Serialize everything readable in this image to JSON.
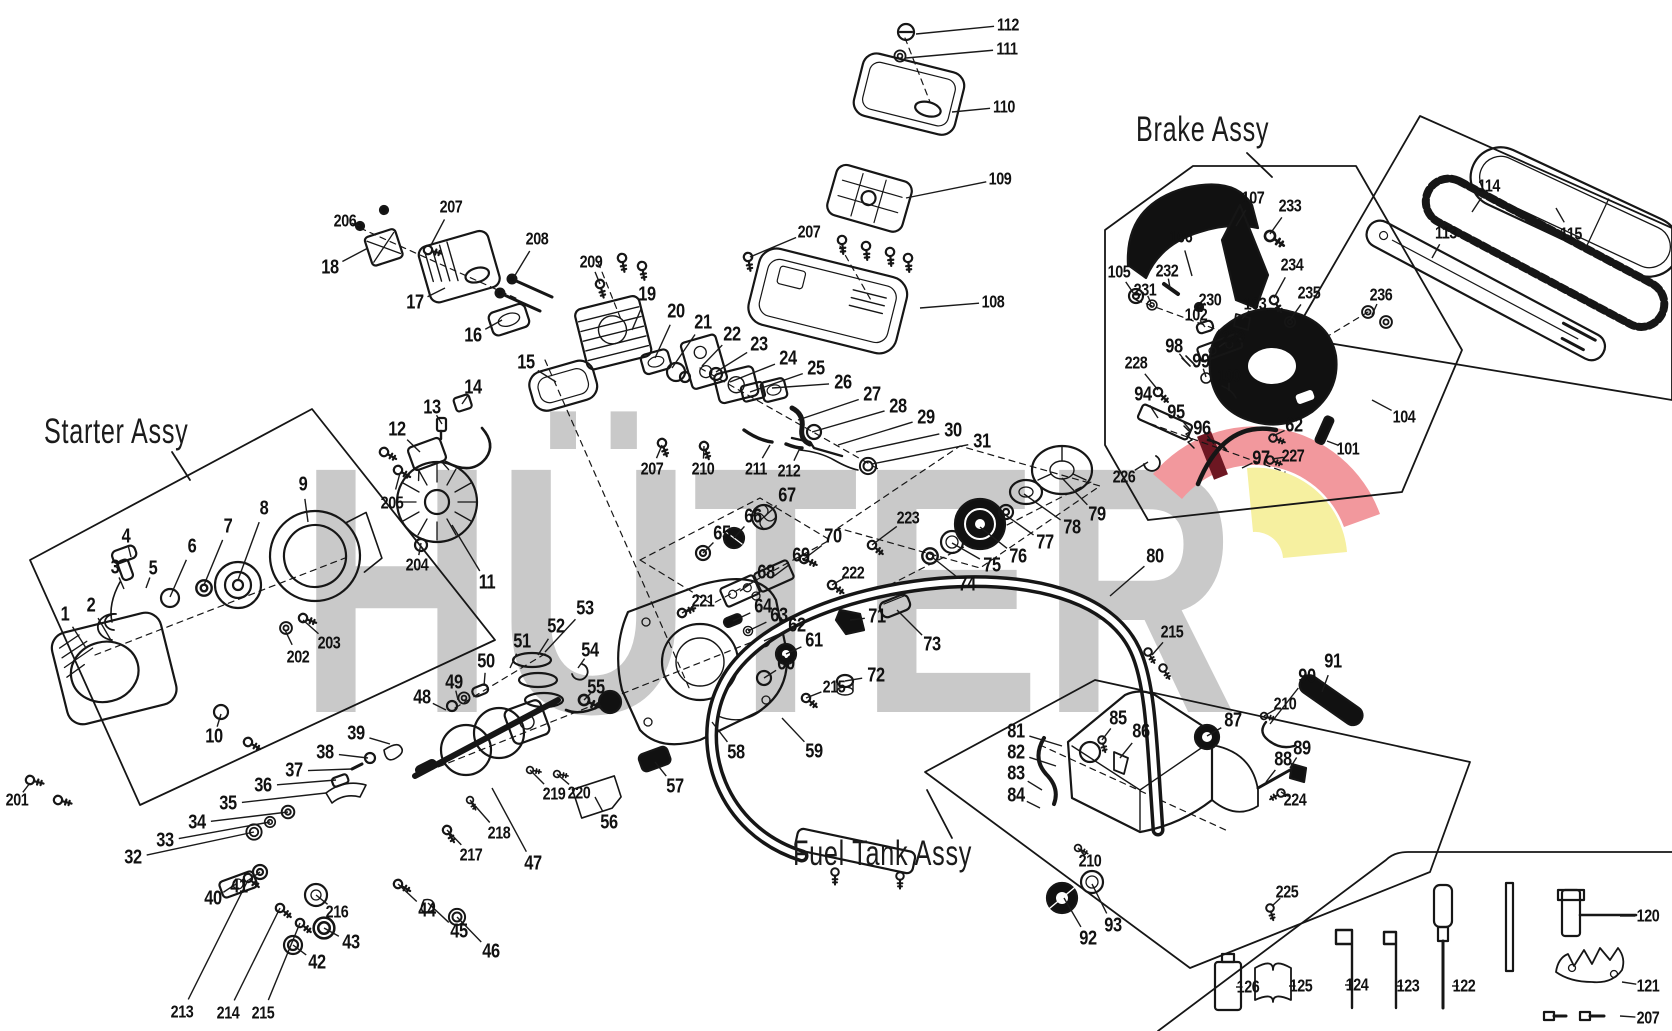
{
  "diagram": {
    "brand_watermark": "HÜTER",
    "watermark_color": "#c9c9c9",
    "line_color": "#1a1a1a",
    "background": "#ffffff",
    "emblem": {
      "band": "#f2989d",
      "stripe": "#6d1722",
      "wedge": "#f6f0a0"
    }
  },
  "groups": [
    {
      "id": "starter",
      "label": "Starter Assy"
    },
    {
      "id": "brake",
      "label": "Brake Assy"
    },
    {
      "id": "fuel",
      "label": "Fuel Tank Assy"
    }
  ],
  "callouts": [
    {
      "id": "112",
      "x": 1008,
      "y": 25,
      "tx": 916,
      "ty": 34
    },
    {
      "id": "111",
      "x": 1007,
      "y": 49,
      "tx": 906,
      "ty": 58
    },
    {
      "id": "110",
      "x": 1004,
      "y": 107,
      "tx": 952,
      "ty": 112
    },
    {
      "id": "109",
      "x": 1000,
      "y": 179,
      "tx": 906,
      "ty": 198
    },
    {
      "id": "108",
      "x": 993,
      "y": 302,
      "tx": 920,
      "ty": 308
    },
    {
      "id": "207",
      "x": 809,
      "y": 232,
      "tx": 750,
      "ty": 257
    },
    {
      "id": "209",
      "x": 591,
      "y": 262,
      "tx": 600,
      "ty": 284
    },
    {
      "id": "206",
      "x": 345,
      "y": 221,
      "tx": 360,
      "ty": 226
    },
    {
      "id": "207",
      "x": 451,
      "y": 207,
      "tx": 430,
      "ty": 247
    },
    {
      "id": "18",
      "x": 330,
      "y": 268,
      "tx": 368,
      "ty": 248
    },
    {
      "id": "17",
      "x": 415,
      "y": 303,
      "tx": 445,
      "ty": 288
    },
    {
      "id": "208",
      "x": 537,
      "y": 239,
      "tx": 514,
      "ty": 277
    },
    {
      "id": "16",
      "x": 473,
      "y": 336,
      "tx": 502,
      "ty": 320
    },
    {
      "id": "15",
      "x": 526,
      "y": 363,
      "tx": 556,
      "ty": 382
    },
    {
      "id": "19",
      "x": 647,
      "y": 295,
      "tx": 632,
      "ty": 330
    },
    {
      "id": "20",
      "x": 676,
      "y": 312,
      "tx": 655,
      "ty": 358
    },
    {
      "id": "21",
      "x": 703,
      "y": 323,
      "tx": 672,
      "ty": 368
    },
    {
      "id": "22",
      "x": 732,
      "y": 335,
      "tx": 702,
      "ty": 366
    },
    {
      "id": "23",
      "x": 759,
      "y": 345,
      "tx": 716,
      "ty": 372
    },
    {
      "id": "24",
      "x": 788,
      "y": 359,
      "tx": 730,
      "ty": 382
    },
    {
      "id": "25",
      "x": 816,
      "y": 369,
      "tx": 750,
      "ty": 392
    },
    {
      "id": "26",
      "x": 843,
      "y": 383,
      "tx": 772,
      "ty": 388
    },
    {
      "id": "27",
      "x": 872,
      "y": 395,
      "tx": 798,
      "ty": 420
    },
    {
      "id": "28",
      "x": 898,
      "y": 407,
      "tx": 812,
      "ty": 432
    },
    {
      "id": "29",
      "x": 926,
      "y": 418,
      "tx": 838,
      "ty": 445
    },
    {
      "id": "30",
      "x": 953,
      "y": 431,
      "tx": 856,
      "ty": 452
    },
    {
      "id": "31",
      "x": 982,
      "y": 442,
      "tx": 872,
      "ty": 464
    },
    {
      "id": "211",
      "x": 756,
      "y": 469,
      "tx": 770,
      "ty": 445
    },
    {
      "id": "212",
      "x": 789,
      "y": 471,
      "tx": 800,
      "ty": 448
    },
    {
      "id": "207",
      "x": 652,
      "y": 469,
      "tx": 662,
      "ty": 445
    },
    {
      "id": "210",
      "x": 703,
      "y": 469,
      "tx": 704,
      "ty": 446
    },
    {
      "id": "12",
      "x": 397,
      "y": 430,
      "tx": 420,
      "ty": 452
    },
    {
      "id": "13",
      "x": 432,
      "y": 408,
      "tx": 442,
      "ty": 424
    },
    {
      "id": "14",
      "x": 473,
      "y": 388,
      "tx": 462,
      "ty": 404
    },
    {
      "id": "205",
      "x": 392,
      "y": 503,
      "tx": 400,
      "ty": 473
    },
    {
      "id": "204",
      "x": 417,
      "y": 565,
      "tx": 421,
      "ty": 543
    },
    {
      "id": "11",
      "x": 487,
      "y": 583,
      "tx": 452,
      "ty": 525
    },
    {
      "id": "1",
      "x": 65,
      "y": 615,
      "tx": 86,
      "ty": 648
    },
    {
      "id": "2",
      "x": 91,
      "y": 606,
      "tx": 112,
      "ty": 642
    },
    {
      "id": "3",
      "x": 115,
      "y": 568,
      "tx": 124,
      "ty": 589
    },
    {
      "id": "4",
      "x": 126,
      "y": 537,
      "tx": 131,
      "ty": 557
    },
    {
      "id": "5",
      "x": 153,
      "y": 569,
      "tx": 146,
      "ty": 588
    },
    {
      "id": "6",
      "x": 192,
      "y": 547,
      "tx": 170,
      "ty": 597
    },
    {
      "id": "7",
      "x": 228,
      "y": 527,
      "tx": 204,
      "ty": 585
    },
    {
      "id": "8",
      "x": 264,
      "y": 509,
      "tx": 238,
      "ty": 580
    },
    {
      "id": "9",
      "x": 303,
      "y": 485,
      "tx": 308,
      "ty": 522
    },
    {
      "id": "10",
      "x": 214,
      "y": 737,
      "tx": 221,
      "ty": 714
    },
    {
      "id": "201",
      "x": 17,
      "y": 800,
      "tx": 30,
      "ty": 783
    },
    {
      "id": "202",
      "x": 298,
      "y": 657,
      "tx": 285,
      "ty": 630
    },
    {
      "id": "203",
      "x": 329,
      "y": 643,
      "tx": 303,
      "ty": 620
    },
    {
      "id": "52",
      "x": 556,
      "y": 627,
      "tx": 538,
      "ty": 655
    },
    {
      "id": "53",
      "x": 585,
      "y": 609,
      "tx": 545,
      "ty": 652
    },
    {
      "id": "51",
      "x": 522,
      "y": 642,
      "tx": 510,
      "ty": 668
    },
    {
      "id": "50",
      "x": 486,
      "y": 662,
      "tx": 484,
      "ty": 686
    },
    {
      "id": "49",
      "x": 454,
      "y": 683,
      "tx": 458,
      "ty": 700
    },
    {
      "id": "48",
      "x": 422,
      "y": 698,
      "tx": 446,
      "ty": 710
    },
    {
      "id": "54",
      "x": 590,
      "y": 651,
      "tx": 578,
      "ty": 668
    },
    {
      "id": "55",
      "x": 596,
      "y": 688,
      "tx": 584,
      "ty": 700
    },
    {
      "id": "39",
      "x": 356,
      "y": 734,
      "tx": 390,
      "ty": 744
    },
    {
      "id": "38",
      "x": 325,
      "y": 753,
      "tx": 368,
      "ty": 758
    },
    {
      "id": "37",
      "x": 294,
      "y": 771,
      "tx": 352,
      "ty": 769
    },
    {
      "id": "36",
      "x": 263,
      "y": 786,
      "tx": 336,
      "ty": 780
    },
    {
      "id": "35",
      "x": 228,
      "y": 804,
      "tx": 326,
      "ty": 793
    },
    {
      "id": "34",
      "x": 197,
      "y": 823,
      "tx": 288,
      "ty": 812
    },
    {
      "id": "33",
      "x": 165,
      "y": 841,
      "tx": 270,
      "ty": 822
    },
    {
      "id": "32",
      "x": 133,
      "y": 858,
      "tx": 254,
      "ty": 832
    },
    {
      "id": "40",
      "x": 213,
      "y": 899,
      "tx": 236,
      "ty": 884
    },
    {
      "id": "41",
      "x": 239,
      "y": 887,
      "tx": 260,
      "ty": 872
    },
    {
      "id": "216",
      "x": 337,
      "y": 912,
      "tx": 316,
      "ty": 895
    },
    {
      "id": "42",
      "x": 317,
      "y": 963,
      "tx": 293,
      "ty": 945
    },
    {
      "id": "43",
      "x": 351,
      "y": 943,
      "tx": 324,
      "ty": 928
    },
    {
      "id": "213",
      "x": 182,
      "y": 1012,
      "tx": 248,
      "ty": 880
    },
    {
      "id": "214",
      "x": 228,
      "y": 1013,
      "tx": 280,
      "ty": 908
    },
    {
      "id": "215",
      "x": 263,
      "y": 1013,
      "tx": 300,
      "ty": 923
    },
    {
      "id": "44",
      "x": 427,
      "y": 911,
      "tx": 398,
      "ty": 884
    },
    {
      "id": "45",
      "x": 459,
      "y": 932,
      "tx": 428,
      "ty": 903
    },
    {
      "id": "46",
      "x": 491,
      "y": 952,
      "tx": 457,
      "ty": 917
    },
    {
      "id": "217",
      "x": 471,
      "y": 855,
      "tx": 447,
      "ty": 830
    },
    {
      "id": "218",
      "x": 499,
      "y": 833,
      "tx": 470,
      "ty": 800
    },
    {
      "id": "47",
      "x": 533,
      "y": 864,
      "tx": 492,
      "ty": 788
    },
    {
      "id": "219",
      "x": 554,
      "y": 794,
      "tx": 530,
      "ty": 770
    },
    {
      "id": "220",
      "x": 579,
      "y": 793,
      "tx": 557,
      "ty": 774
    },
    {
      "id": "56",
      "x": 609,
      "y": 823,
      "tx": 595,
      "ty": 797
    },
    {
      "id": "57",
      "x": 675,
      "y": 787,
      "tx": 655,
      "ty": 762
    },
    {
      "id": "58",
      "x": 736,
      "y": 753,
      "tx": 712,
      "ty": 722
    },
    {
      "id": "59",
      "x": 814,
      "y": 752,
      "tx": 782,
      "ty": 718
    },
    {
      "id": "60",
      "x": 786,
      "y": 664,
      "tx": 764,
      "ty": 678
    },
    {
      "id": "215",
      "x": 834,
      "y": 687,
      "tx": 806,
      "ty": 698
    },
    {
      "id": "61",
      "x": 814,
      "y": 641,
      "tx": 786,
      "ty": 654
    },
    {
      "id": "62",
      "x": 797,
      "y": 626,
      "tx": 764,
      "ty": 641
    },
    {
      "id": "63",
      "x": 779,
      "y": 616,
      "tx": 748,
      "ty": 631
    },
    {
      "id": "64",
      "x": 763,
      "y": 607,
      "tx": 733,
      "ty": 621
    },
    {
      "id": "221",
      "x": 703,
      "y": 601,
      "tx": 682,
      "ty": 613
    },
    {
      "id": "68",
      "x": 766,
      "y": 573,
      "tx": 740,
      "ty": 591
    },
    {
      "id": "69",
      "x": 801,
      "y": 556,
      "tx": 774,
      "ty": 576
    },
    {
      "id": "70",
      "x": 833,
      "y": 537,
      "tx": 804,
      "ty": 559
    },
    {
      "id": "67",
      "x": 787,
      "y": 496,
      "tx": 764,
      "ty": 517
    },
    {
      "id": "66",
      "x": 753,
      "y": 517,
      "tx": 734,
      "ty": 538
    },
    {
      "id": "65",
      "x": 722,
      "y": 534,
      "tx": 703,
      "ty": 553
    },
    {
      "id": "222",
      "x": 853,
      "y": 573,
      "tx": 832,
      "ty": 585
    },
    {
      "id": "71",
      "x": 877,
      "y": 617,
      "tx": 850,
      "ty": 620
    },
    {
      "id": "72",
      "x": 876,
      "y": 676,
      "tx": 845,
      "ty": 681
    },
    {
      "id": "73",
      "x": 932,
      "y": 645,
      "tx": 897,
      "ty": 610
    },
    {
      "id": "223",
      "x": 908,
      "y": 518,
      "tx": 872,
      "ty": 545
    },
    {
      "id": "74",
      "x": 967,
      "y": 585,
      "tx": 932,
      "ty": 557
    },
    {
      "id": "75",
      "x": 992,
      "y": 566,
      "tx": 952,
      "ty": 543
    },
    {
      "id": "76",
      "x": 1018,
      "y": 557,
      "tx": 980,
      "ty": 527
    },
    {
      "id": "77",
      "x": 1045,
      "y": 543,
      "tx": 1004,
      "ty": 514
    },
    {
      "id": "78",
      "x": 1072,
      "y": 528,
      "tx": 1024,
      "ty": 494
    },
    {
      "id": "79",
      "x": 1097,
      "y": 515,
      "tx": 1062,
      "ty": 478
    },
    {
      "id": "80",
      "x": 1155,
      "y": 557,
      "tx": 1110,
      "ty": 596
    },
    {
      "id": "105",
      "x": 1119,
      "y": 272,
      "tx": 1134,
      "ty": 294
    },
    {
      "id": "231",
      "x": 1145,
      "y": 290,
      "tx": 1151,
      "ty": 303
    },
    {
      "id": "232",
      "x": 1167,
      "y": 271,
      "tx": 1170,
      "ty": 288
    },
    {
      "id": "106",
      "x": 1181,
      "y": 237,
      "tx": 1192,
      "ty": 276
    },
    {
      "id": "107",
      "x": 1253,
      "y": 198,
      "tx": 1236,
      "ty": 226
    },
    {
      "id": "233",
      "x": 1290,
      "y": 206,
      "tx": 1270,
      "ty": 234
    },
    {
      "id": "230",
      "x": 1210,
      "y": 300,
      "tx": 1199,
      "ty": 307
    },
    {
      "id": "102",
      "x": 1196,
      "y": 315,
      "tx": 1205,
      "ty": 327
    },
    {
      "id": "229",
      "x": 1233,
      "y": 337,
      "tx": 1219,
      "ty": 347
    },
    {
      "id": "103",
      "x": 1255,
      "y": 304,
      "tx": 1242,
      "ty": 319
    },
    {
      "id": "234",
      "x": 1292,
      "y": 265,
      "tx": 1274,
      "ty": 298
    },
    {
      "id": "235",
      "x": 1309,
      "y": 293,
      "tx": 1290,
      "ty": 320
    },
    {
      "id": "98",
      "x": 1174,
      "y": 347,
      "tx": 1186,
      "ty": 362
    },
    {
      "id": "99",
      "x": 1201,
      "y": 362,
      "tx": 1206,
      "ty": 377
    },
    {
      "id": "100",
      "x": 1229,
      "y": 376,
      "tx": 1229,
      "ty": 391
    },
    {
      "id": "228",
      "x": 1136,
      "y": 363,
      "tx": 1158,
      "ty": 390
    },
    {
      "id": "94",
      "x": 1143,
      "y": 395,
      "tx": 1158,
      "ty": 418
    },
    {
      "id": "95",
      "x": 1176,
      "y": 413,
      "tx": 1190,
      "ty": 430
    },
    {
      "id": "96",
      "x": 1202,
      "y": 429,
      "tx": 1214,
      "ty": 444
    },
    {
      "id": "97",
      "x": 1261,
      "y": 459,
      "tx": 1242,
      "ty": 468
    },
    {
      "id": "227",
      "x": 1293,
      "y": 456,
      "tx": 1272,
      "ty": 459
    },
    {
      "id": "62",
      "x": 1294,
      "y": 426,
      "tx": 1273,
      "ty": 436
    },
    {
      "id": "101",
      "x": 1348,
      "y": 449,
      "tx": 1327,
      "ty": 441
    },
    {
      "id": "104",
      "x": 1404,
      "y": 417,
      "tx": 1372,
      "ty": 400
    },
    {
      "id": "226",
      "x": 1124,
      "y": 477,
      "tx": 1148,
      "ty": 462
    },
    {
      "id": "236",
      "x": 1381,
      "y": 295,
      "tx": 1372,
      "ty": 315
    },
    {
      "id": "113",
      "x": 1446,
      "y": 233,
      "tx": 1432,
      "ty": 258
    },
    {
      "id": "114",
      "x": 1489,
      "y": 186,
      "tx": 1472,
      "ty": 212
    },
    {
      "id": "115",
      "x": 1571,
      "y": 234,
      "tx": 1556,
      "ty": 208
    },
    {
      "id": "81",
      "x": 1016,
      "y": 732,
      "tx": 1062,
      "ty": 746
    },
    {
      "id": "82",
      "x": 1016,
      "y": 753,
      "tx": 1056,
      "ty": 766
    },
    {
      "id": "83",
      "x": 1016,
      "y": 774,
      "tx": 1042,
      "ty": 790
    },
    {
      "id": "84",
      "x": 1016,
      "y": 796,
      "tx": 1040,
      "ty": 808
    },
    {
      "id": "85",
      "x": 1118,
      "y": 719,
      "tx": 1102,
      "ty": 740
    },
    {
      "id": "86",
      "x": 1141,
      "y": 732,
      "tx": 1120,
      "ty": 758
    },
    {
      "id": "87",
      "x": 1233,
      "y": 721,
      "tx": 1207,
      "ty": 736
    },
    {
      "id": "210",
      "x": 1285,
      "y": 704,
      "tx": 1264,
      "ty": 716
    },
    {
      "id": "90",
      "x": 1307,
      "y": 677,
      "tx": 1270,
      "ty": 724
    },
    {
      "id": "91",
      "x": 1333,
      "y": 662,
      "tx": 1322,
      "ty": 692
    },
    {
      "id": "88",
      "x": 1283,
      "y": 760,
      "tx": 1266,
      "ty": 782
    },
    {
      "id": "89",
      "x": 1302,
      "y": 749,
      "tx": 1290,
      "ty": 768
    },
    {
      "id": "224",
      "x": 1295,
      "y": 800,
      "tx": 1281,
      "ty": 792
    },
    {
      "id": "225",
      "x": 1287,
      "y": 892,
      "tx": 1272,
      "ty": 906
    },
    {
      "id": "210",
      "x": 1090,
      "y": 861,
      "tx": 1078,
      "ty": 848
    },
    {
      "id": "92",
      "x": 1088,
      "y": 939,
      "tx": 1064,
      "ty": 898
    },
    {
      "id": "93",
      "x": 1113,
      "y": 926,
      "tx": 1092,
      "ty": 884
    },
    {
      "id": "215",
      "x": 1172,
      "y": 632,
      "tx": 1152,
      "ty": 655
    },
    {
      "id": "126",
      "x": 1248,
      "y": 987,
      "tx": 1236,
      "ty": 987
    },
    {
      "id": "125",
      "x": 1301,
      "y": 986,
      "tx": 1289,
      "ty": 986
    },
    {
      "id": "124",
      "x": 1357,
      "y": 985,
      "tx": 1345,
      "ty": 985
    },
    {
      "id": "123",
      "x": 1408,
      "y": 986,
      "tx": 1396,
      "ty": 986
    },
    {
      "id": "122",
      "x": 1464,
      "y": 986,
      "tx": 1452,
      "ty": 986
    },
    {
      "id": "120",
      "x": 1648,
      "y": 916,
      "tx": 1620,
      "ty": 916
    },
    {
      "id": "121",
      "x": 1648,
      "y": 986,
      "tx": 1622,
      "ty": 982
    },
    {
      "id": "207",
      "x": 1648,
      "y": 1018,
      "tx": 1620,
      "ty": 1016
    }
  ]
}
